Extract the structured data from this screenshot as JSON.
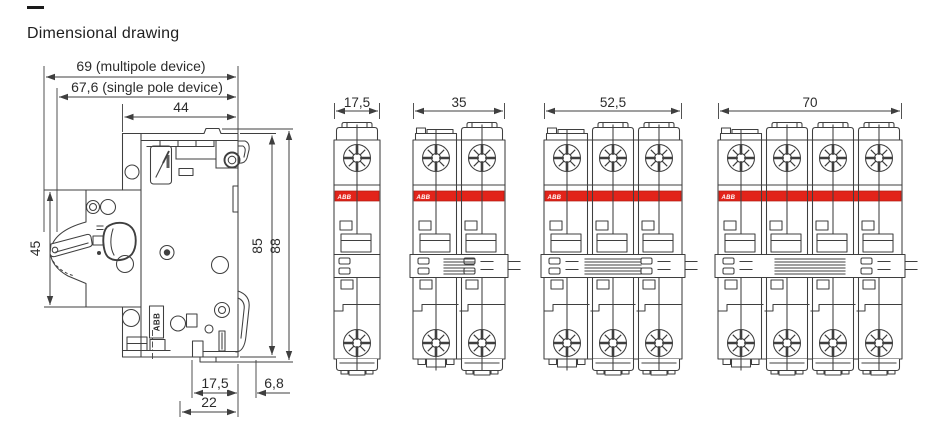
{
  "title": "Dimensional drawing",
  "colors": {
    "brand_red": "#e2231a",
    "line": "#3f3f3f",
    "text": "#262626"
  },
  "side_view": {
    "dims": {
      "depth_multipole": "69 (multipole device)",
      "depth_single_pole": "67,6 (single pole device)",
      "depth_housing": "44",
      "front_height": "45",
      "height_body": "85",
      "height_total": "88",
      "base_front": "17,5",
      "base_rear": "6,8",
      "base_total": "22"
    },
    "brand_label": "ABB"
  },
  "front_views": [
    {
      "poles": 1,
      "width_mm": "17,5",
      "brand": "ABB"
    },
    {
      "poles": 2,
      "width_mm": "35",
      "brand": "ABB"
    },
    {
      "poles": 3,
      "width_mm": "52,5",
      "brand": "ABB"
    },
    {
      "poles": 4,
      "width_mm": "70",
      "brand": "ABB"
    }
  ]
}
